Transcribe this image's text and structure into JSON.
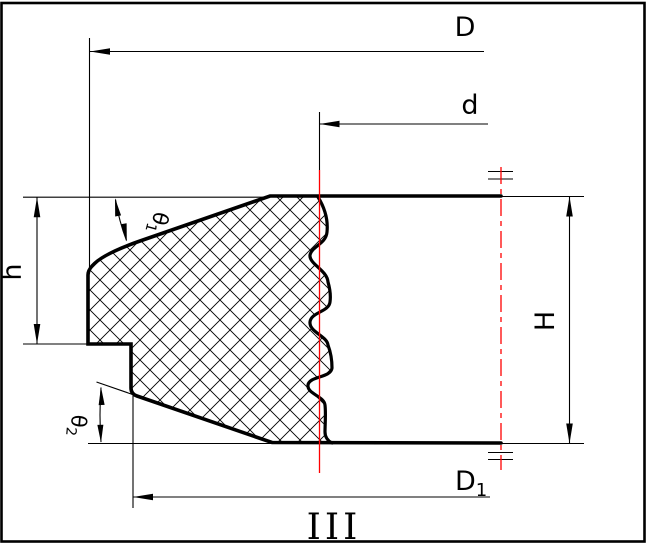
{
  "colors": {
    "ink": "#000000",
    "centerline": "#ff0000",
    "paper": "#ffffff"
  },
  "drawing": {
    "view_label": "III",
    "dim_D": "D",
    "dim_d": "d",
    "dim_h": "h",
    "dim_H": "H",
    "dim_D1_base": "D",
    "dim_D1_sub": "1",
    "dim_theta1_base": "θ",
    "dim_theta1_sub": "1",
    "dim_theta2_base": "θ",
    "dim_theta2_sub": "2"
  }
}
